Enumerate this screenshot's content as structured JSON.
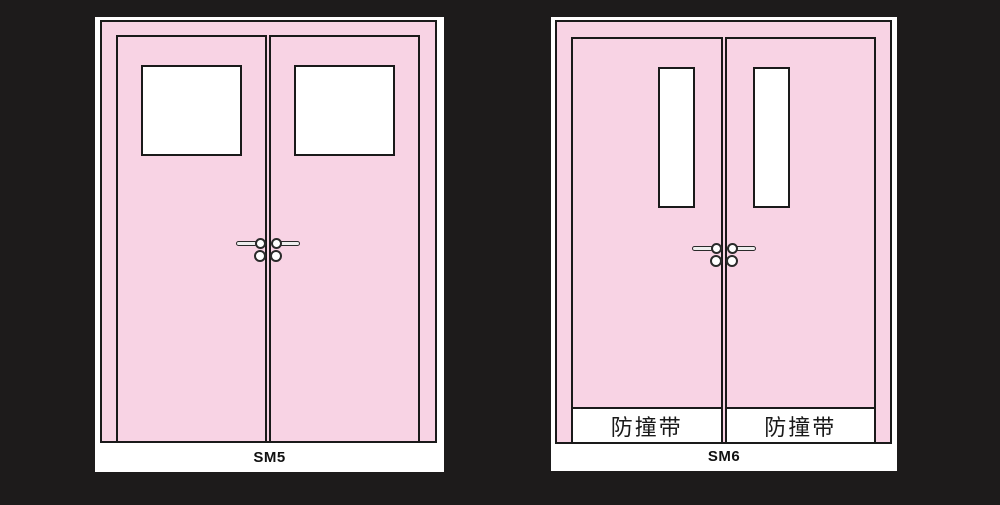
{
  "colors": {
    "background": "#1d1b1b",
    "door_pink": "#f8d3e4",
    "outline": "#1a1a1a",
    "panel_white": "#ffffff",
    "handle_fill": "#eeeeee"
  },
  "panels": [
    {
      "label": "SM5"
    },
    {
      "label": "SM6",
      "bumper_strips": [
        "防撞带",
        "防撞带"
      ]
    }
  ]
}
